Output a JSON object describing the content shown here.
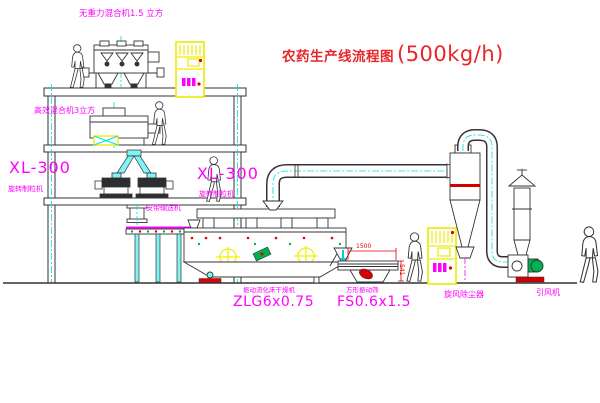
{
  "title": {
    "name_cn": "农药生产线流程图",
    "capacity": "(500kg/h)"
  },
  "equipment_labels": {
    "gravity_mixer": "无重力混合机1.5 立方",
    "efficient_mixer": "高效混合机3立方",
    "granulator_left": {
      "model": "XL-300",
      "name": "旋转制粒机"
    },
    "granulator_right": {
      "model": "XL-300",
      "name": "旋转制粒机"
    },
    "belt_conveyor": "皮带输送机",
    "fluid_bed_dryer": {
      "name": "振动流化床干燥机",
      "model": "ZLG6x0.75"
    },
    "vibrating_sieve": {
      "name": "方形振动筛",
      "model": "FS0.6x1.5"
    },
    "cyclone": "旋风除尘器",
    "induced_draft_fan": "引风机"
  },
  "dimensions": {
    "sieve_length": "1500",
    "sieve_height": "541"
  },
  "colors": {
    "label_magenta": "#FF00FF",
    "title_red": "#E8262A",
    "dim_red": "#E00000",
    "pipe_cyan": "#00E0E0",
    "cabinet_yellow": "#EDED00",
    "machine_green": "#00B050",
    "line_dark": "#333333"
  }
}
